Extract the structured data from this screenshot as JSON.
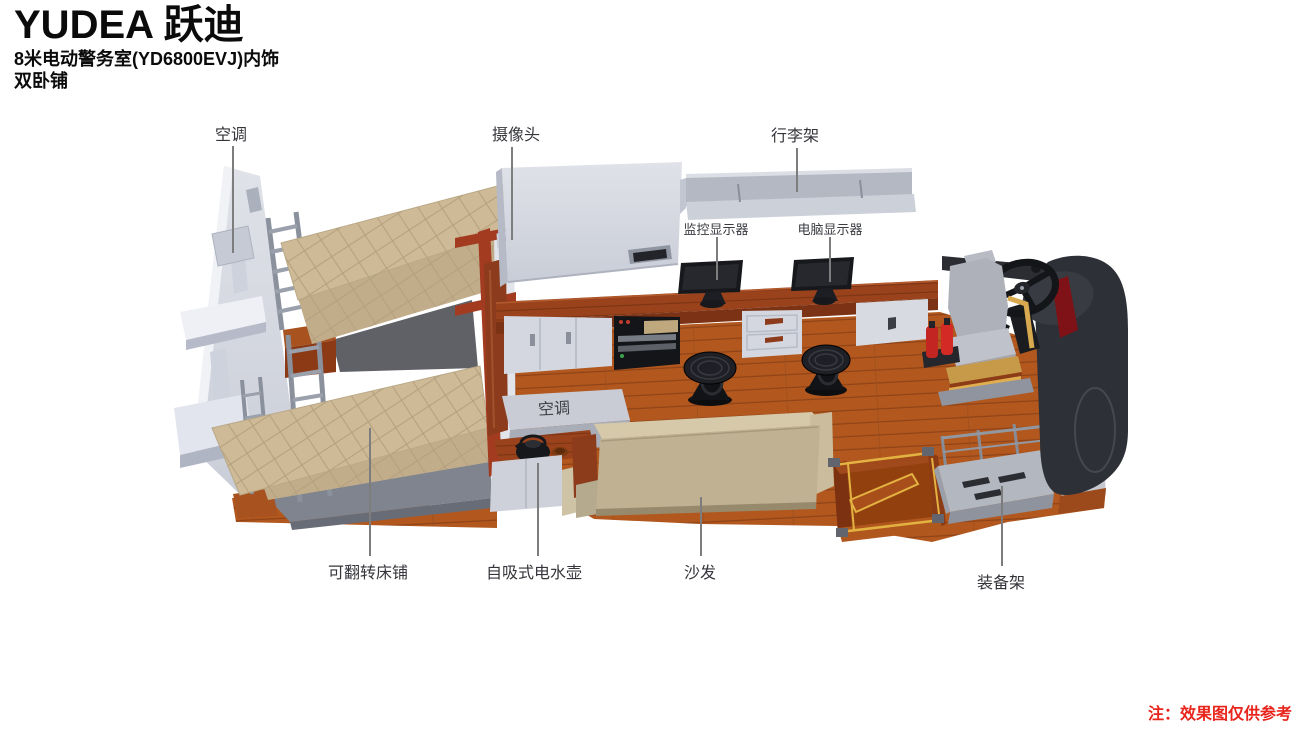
{
  "header": {
    "brand": "YUDEA 跃迪",
    "subtitle_line1": "8米电动警务室(YD6800EVJ)内饰",
    "subtitle_line2": "双卧铺"
  },
  "annotations": {
    "ac_top": "空调",
    "camera": "摄像头",
    "luggage_rack": "行李架",
    "monitor_surveillance": "监控显示器",
    "monitor_computer": "电脑显示器",
    "ac_mid": "空调",
    "flip_bed": "可翻转床铺",
    "kettle": "自吸式电水壶",
    "sofa": "沙发",
    "equipment_rack": "装备架"
  },
  "footnote": "注：效果图仅供参考",
  "colors": {
    "note_red": "#e8251c",
    "wood_floor": "#b2581e",
    "wood_desk": "#9a421c",
    "mattress_tan": "#cfba97",
    "sofa_tan": "#bfb191",
    "wall_gray": "#d8dbe3",
    "dark_trim": "#2e3037",
    "accent_yellow": "#e0ae4e",
    "extinguisher_red": "#c32522"
  }
}
